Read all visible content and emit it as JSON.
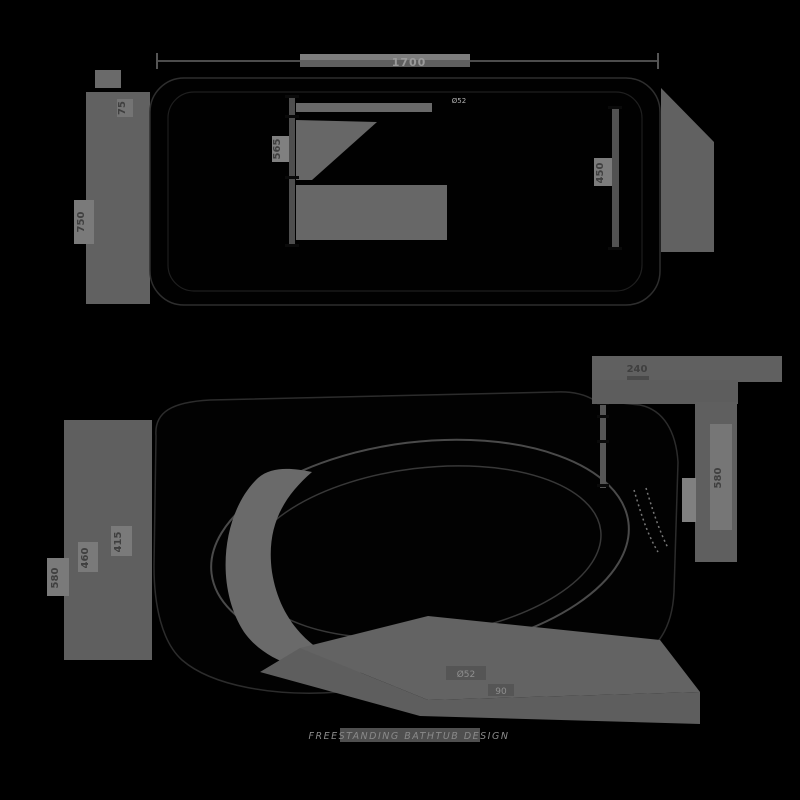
{
  "top_view": {
    "length_label": "1700",
    "width_label": "750",
    "rim_label": "75",
    "drain_label": "Ø52",
    "inner_width_label": "565",
    "inner_right_label": "450"
  },
  "perspective_view": {
    "top_right_label": "240",
    "height_outer_label": "580",
    "depth_label": "460",
    "water_depth_label": "415",
    "right_height_label": "580",
    "drain_label": "Ø52",
    "drain_offset_label": "90"
  },
  "watermark": "FREESTANDING BATHTUB DESIGN",
  "colors": {
    "background": "#000000",
    "shadow": "#616161",
    "dim_line": "#4f4f4f",
    "label_bg": "#7a7a7a",
    "label_text": "#3f3f3f",
    "light_text": "#9a9a9a",
    "outline": "#2e2e2e"
  }
}
